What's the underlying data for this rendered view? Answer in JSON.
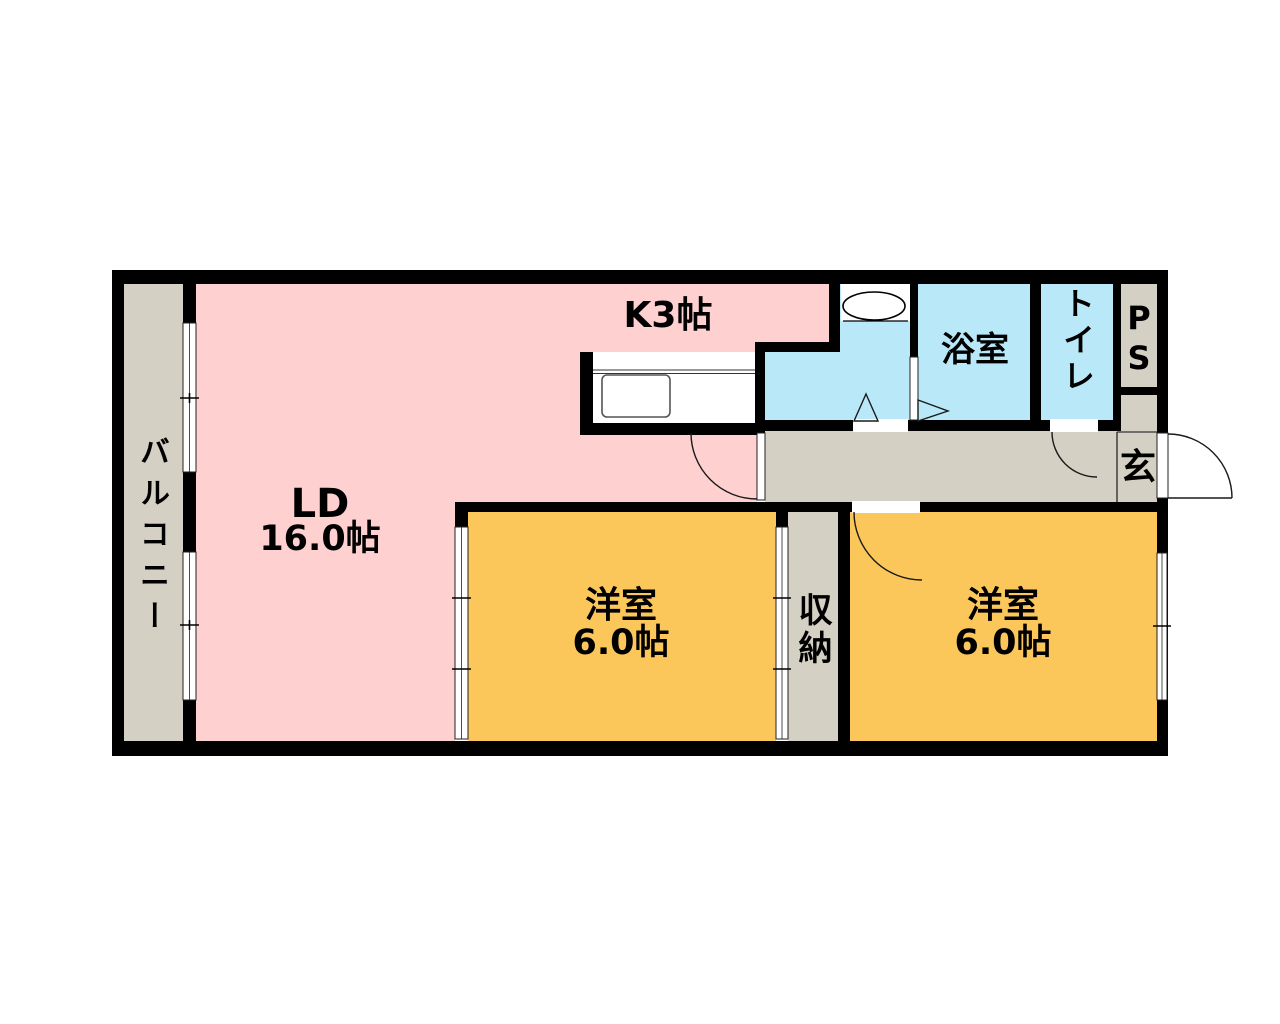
{
  "plan": {
    "balcony": {
      "label": "バルコニー"
    },
    "living_dining": {
      "name": "LD",
      "area": "16.0帖"
    },
    "kitchen": {
      "label": "K3帖"
    },
    "bathroom": {
      "label": "浴室"
    },
    "toilet": {
      "label": "トイレ"
    },
    "pipe_space": {
      "label": "PS"
    },
    "entrance": {
      "label": "玄"
    },
    "closet": {
      "label": "収納"
    },
    "western_room_left": {
      "name": "洋室",
      "area": "6.0帖"
    },
    "western_room_right": {
      "name": "洋室",
      "area": "6.0帖"
    },
    "colors": {
      "wall": "#000000",
      "living_dining_fill": "#FFD0D0",
      "western_room_fill": "#FCC75A",
      "wet_area_fill": "#B9E9F8",
      "corridor_fill": "#D4D0C3",
      "opening_fill": "#FFFFFF"
    }
  }
}
